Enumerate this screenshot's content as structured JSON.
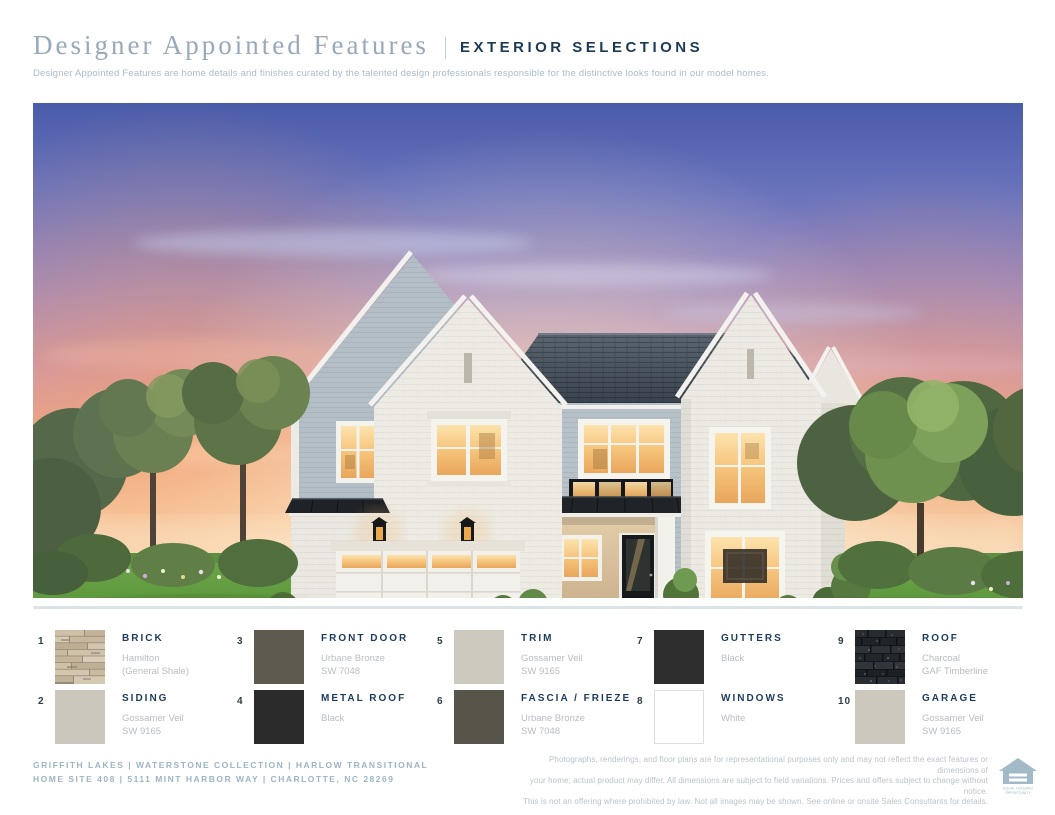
{
  "header": {
    "title_serif": "Designer Appointed Features",
    "title_sans": "EXTERIOR SELECTIONS",
    "subtitle": "Designer Appointed Features are home details and finishes curated by the talented design professionals responsible for the distinctive looks found in our model homes."
  },
  "legend": {
    "items": [
      {
        "num": "1",
        "label": "BRICK",
        "lines": [
          "Hamilton",
          "(General Shale)"
        ],
        "swatch_type": "brick-texture"
      },
      {
        "num": "2",
        "label": "SIDING",
        "lines": [
          "Gossamer Veil",
          "SW 9165"
        ],
        "swatch_color": "#cbc7bc"
      },
      {
        "num": "3",
        "label": "FRONT DOOR",
        "lines": [
          "Urbane Bronze",
          "SW 7048"
        ],
        "swatch_color": "#5e5a50"
      },
      {
        "num": "4",
        "label": "METAL ROOF",
        "lines": [
          "Black"
        ],
        "swatch_color": "#2b2b2c"
      },
      {
        "num": "5",
        "label": "TRIM",
        "lines": [
          "Gossamer Veil",
          "SW 9165"
        ],
        "swatch_color": "#cdc9be"
      },
      {
        "num": "6",
        "label": "FASCIA / FRIEZE",
        "lines": [
          "Urbane Bronze",
          "SW 7048"
        ],
        "swatch_color": "#57544a"
      },
      {
        "num": "7",
        "label": "GUTTERS",
        "lines": [
          "Black"
        ],
        "swatch_color": "#2e2e2f"
      },
      {
        "num": "8",
        "label": "WINDOWS",
        "lines": [
          "White"
        ],
        "swatch_color": "#ffffff",
        "bordered": true
      },
      {
        "num": "9",
        "label": "ROOF",
        "lines": [
          "Charcoal",
          "GAF Timberline"
        ],
        "swatch_type": "roof-texture"
      },
      {
        "num": "10",
        "label": "GARAGE",
        "lines": [
          "Gossamer Veil",
          "SW 9165"
        ],
        "swatch_color": "#ccc8bd"
      }
    ]
  },
  "footer": {
    "left_line1": "GRIFFITH LAKES  |  WATERSTONE COLLECTION  |  HARLOW TRANSITIONAL",
    "left_line2": "HOME SITE 408  |  5111 MINT HARBOR WAY  |  CHARLOTTE, NC 28269",
    "disclaimer_lines": [
      "Photographs, renderings, and floor plans are for representational purposes only and may not reflect the exact features or dimensions of",
      "your home; actual product may differ. All dimensions are subject to field variations. Prices and offers subject to change without notice.",
      "This is not an offering where prohibited by law. Not all images may be shown. See online or onsite Sales Consultants for details."
    ],
    "equal_housing_line1": "EQUAL HOUSING",
    "equal_housing_line2": "OPPORTUNITY"
  },
  "colors": {
    "heading_navy": "#1d3a55",
    "muted_slate": "#98a9b8",
    "legend_sub_gray": "#b7bdc3",
    "footer_slate": "#9cb4c6"
  }
}
